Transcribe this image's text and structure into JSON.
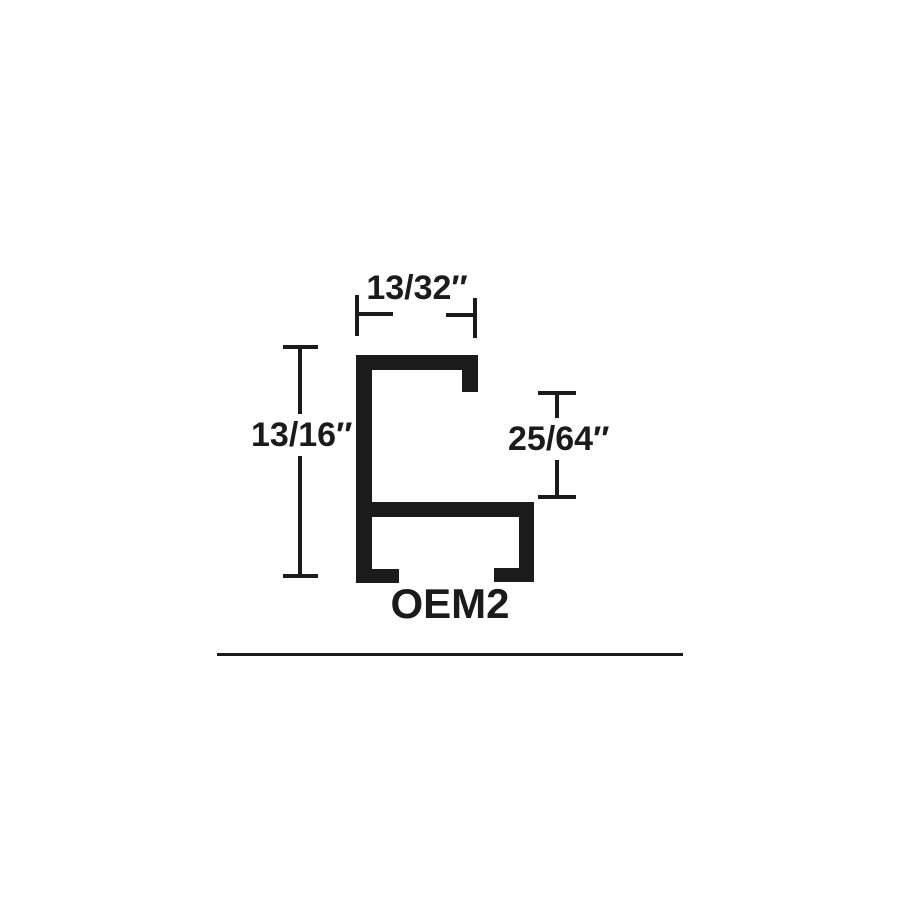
{
  "diagram": {
    "part_label": "OEM2",
    "dimensions": {
      "top_width": "13/32″",
      "left_height": "13/16″",
      "right_opening": "25/64″"
    },
    "colors": {
      "ink": "#1b1b1b",
      "background": "#ffffff"
    }
  }
}
